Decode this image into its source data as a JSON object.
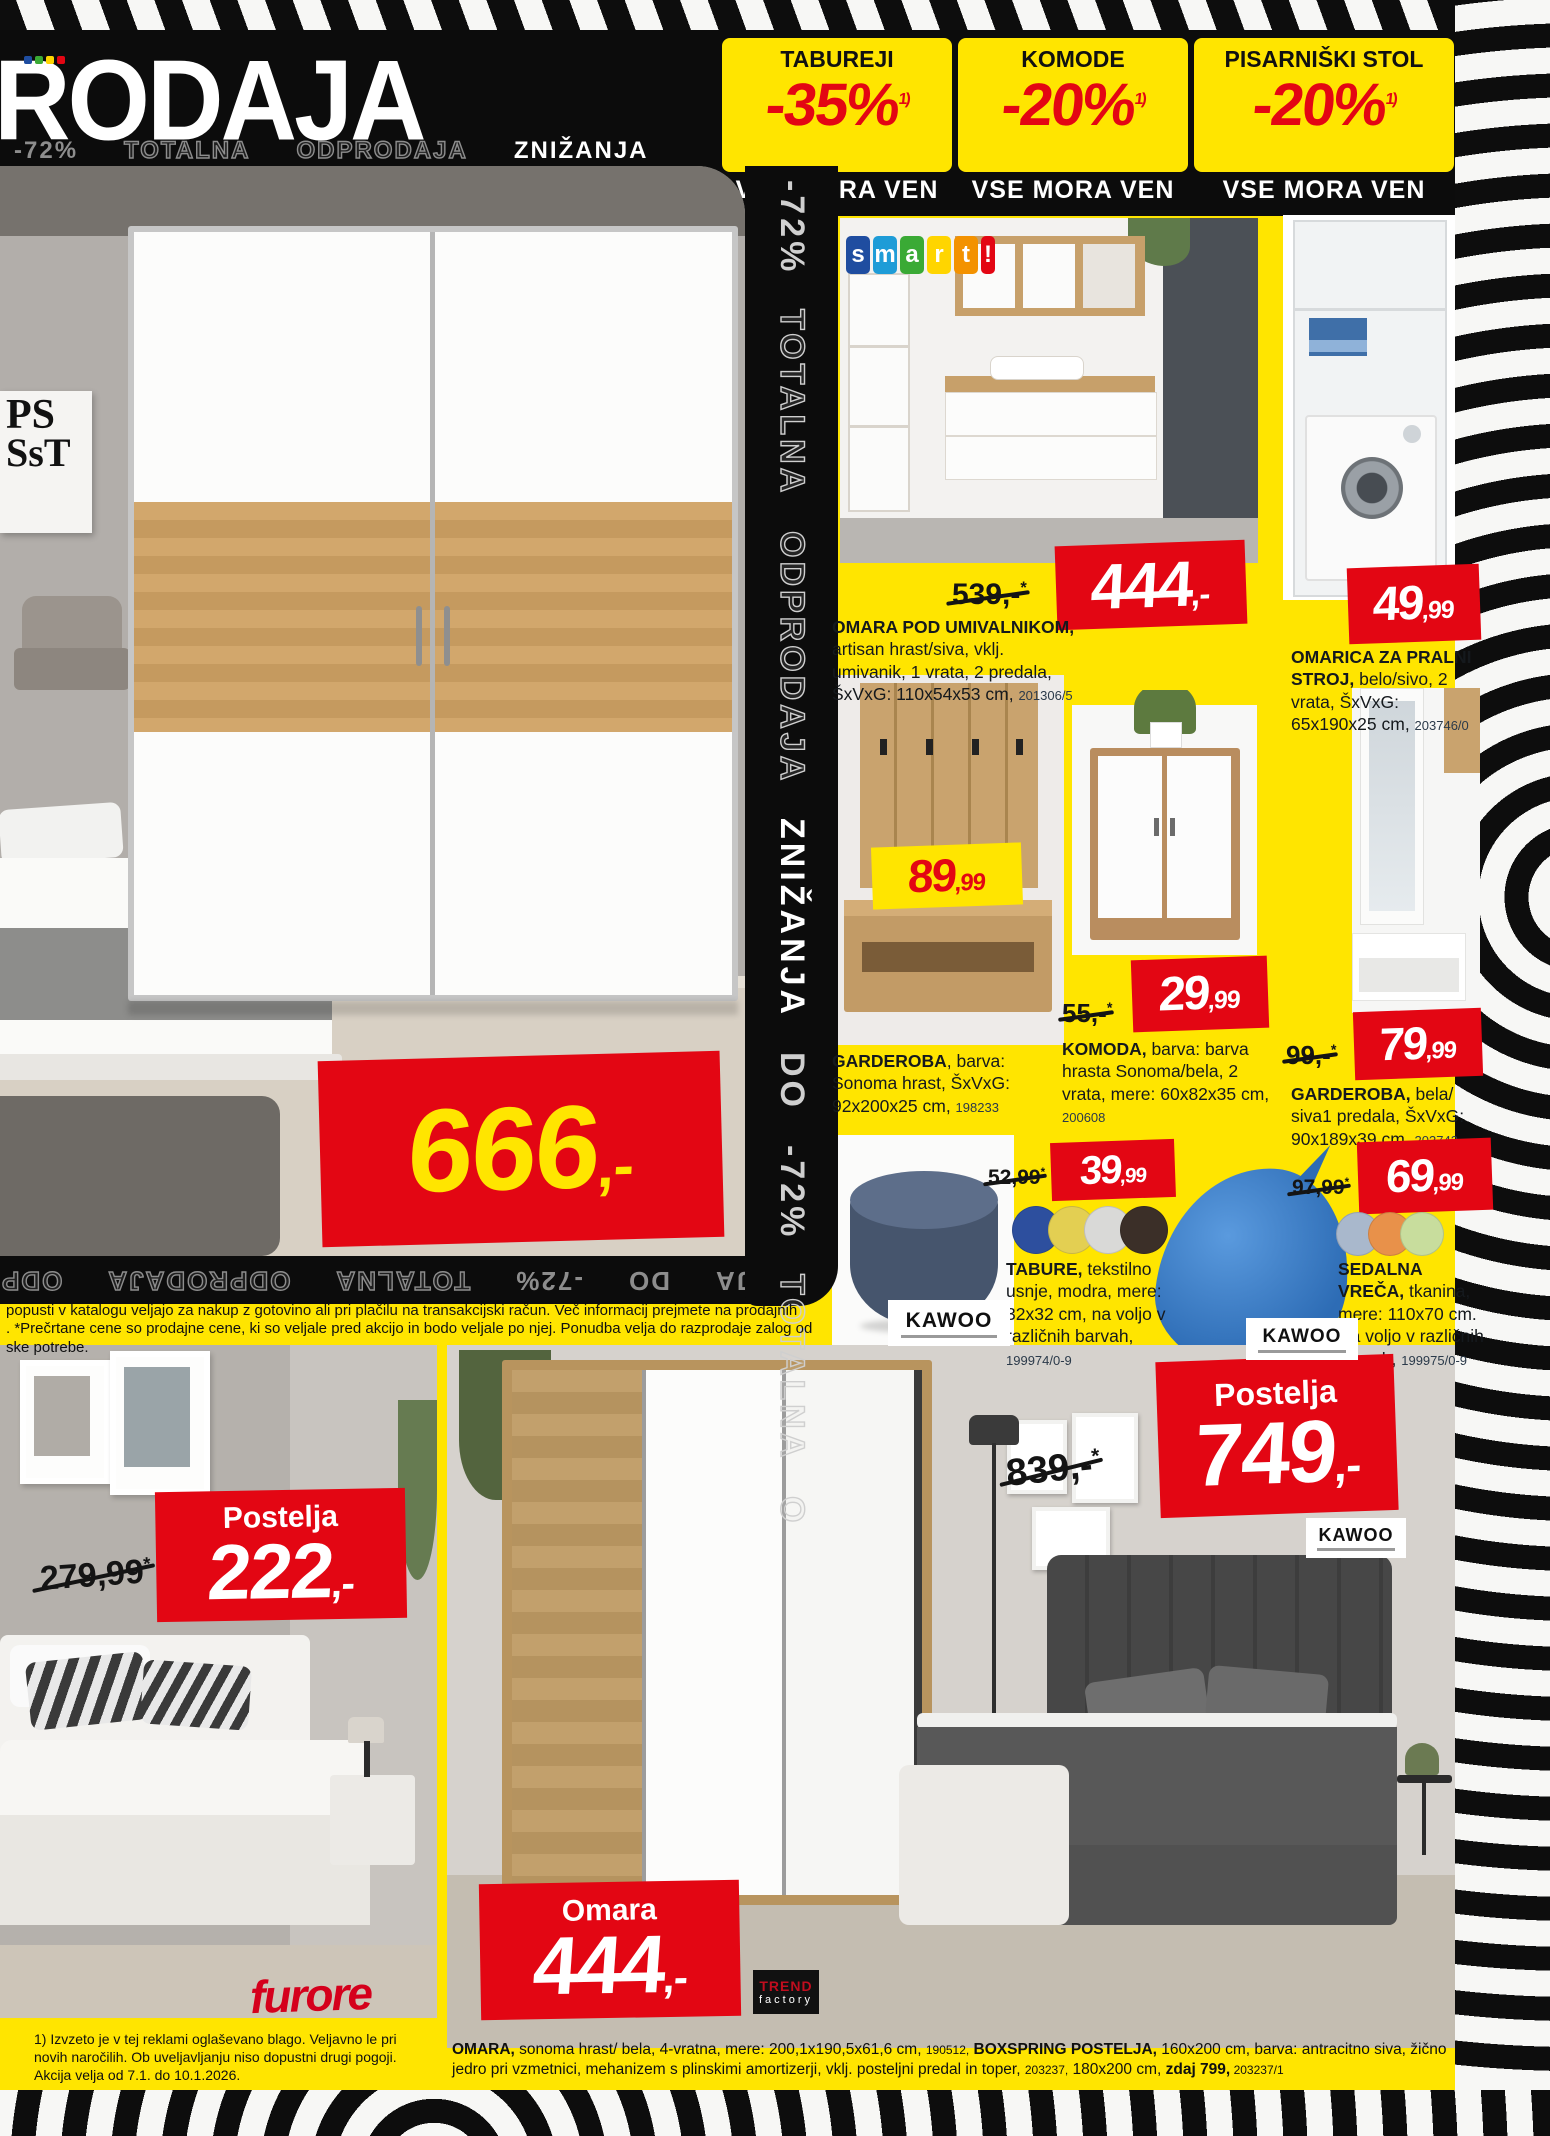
{
  "colors": {
    "yellow": "#ffe500",
    "red": "#e30613",
    "black": "#111111"
  },
  "top": {
    "headline": "RODAJA",
    "mini_logo_colors": [
      "#1f4da0",
      "#3aaa35",
      "#ffd500",
      "#e30613"
    ],
    "strip": [
      {
        "t": "-72%"
      },
      {
        "t": "TOTALNA"
      },
      {
        "t": "ODPRODAJA"
      },
      {
        "t": "ZNIŽANJA"
      }
    ],
    "promos": [
      {
        "category": "TABUREJI",
        "discount": "-35%",
        "note": "1)",
        "tagline": "VSE MORA VEN"
      },
      {
        "category": "KOMODE",
        "discount": "-20%",
        "note": "1)",
        "tagline": "VSE MORA VEN"
      },
      {
        "category": "PISARNIŠKI STOL",
        "discount": "-20%",
        "note": "1)",
        "tagline": "VSE MORA VEN"
      }
    ]
  },
  "watermark": {
    "vertical": [
      {
        "t": "-72%"
      },
      {
        "t": "TOTALNA"
      },
      {
        "t": "ODPRODAJA"
      },
      {
        "t": "ZNIŽANJA"
      },
      {
        "t": "DO"
      },
      {
        "t": "-72%"
      },
      {
        "t": "TOTALNA"
      },
      {
        "t": "O"
      }
    ],
    "flipped": [
      {
        "t": "ZNIŽANJA"
      },
      {
        "t": "DO"
      },
      {
        "t": "-72%"
      },
      {
        "t": "TOTALNA"
      },
      {
        "t": "ODPRODAJA"
      },
      {
        "t": "ODP"
      }
    ]
  },
  "logos": {
    "smart": [
      {
        "ch": "s",
        "bg": "#1f4da0"
      },
      {
        "ch": "m",
        "bg": "#1e9cd7"
      },
      {
        "ch": "a",
        "bg": "#3aaa35"
      },
      {
        "ch": "r",
        "bg": "#ffd500"
      },
      {
        "ch": "t",
        "bg": "#f39200"
      },
      {
        "ch": "!",
        "bg": "#e30613"
      }
    ],
    "kawoo": "KAWOO",
    "furore": "furore",
    "trend_top": "TREND",
    "trend_bottom": "factory"
  },
  "poster": {
    "line1": "PS",
    "line2": "SsT"
  },
  "hero": {
    "price_int": "666",
    "price_cents": ",-"
  },
  "products": [
    {
      "old": "539,-",
      "note": "*",
      "price_int": "444",
      "price_cents": ",-",
      "name": "OMARA POD UMIVALNIKOM,",
      "desc": " artisan hrast/siva, vklj. umivanik, 1 vrata, 2 predala, ŠxVxG: 110x54x53 cm, ",
      "sku": "201306/5"
    },
    {
      "price_int": "49",
      "price_cents": ",99",
      "name": "OMARICA ZA PRALNI STROJ,",
      "desc": " belo/sivo, 2 vrata, ŠxVxG: 65x190x25 cm, ",
      "sku": "203746/0"
    },
    {
      "price_int": "89",
      "price_cents": ",99",
      "name": "GARDEROBA",
      "desc": ", barva: Sonoma hrast, ŠxVxG: 92x200x25 cm, ",
      "sku": "198233"
    },
    {
      "old": "55,-",
      "note": "*",
      "price_int": "29",
      "price_cents": ",99",
      "name": "KOMODA,",
      "desc": " barva: barva hrasta Sonoma/bela, 2 vrata, mere: 60x82x35 cm, ",
      "sku": "200608"
    },
    {
      "old": "99,-",
      "note": "*",
      "price_int": "79",
      "price_cents": ",99",
      "name": "GARDEROBA,",
      "desc": " bela/ siva1 predala, ŠxVxG: 90x189x39 cm, ",
      "sku": "203742"
    },
    {
      "old": "52,99",
      "note": "*",
      "price_int": "39",
      "price_cents": ",99",
      "name": "TABURE,",
      "desc": " tekstilno usnje, modra, mere: 32x32 cm, na voljo v različnih barvah, ",
      "sku": "199974/0-9",
      "swatches": [
        "#2d4f9e",
        "#e3cf52",
        "#d9d9d7",
        "#3b2f28"
      ]
    },
    {
      "old": "97,99",
      "note": "*",
      "price_int": "69",
      "price_cents": ",99",
      "name": "SEDALNA VREČA,",
      "desc": " tkanina, mere: 110x70 cm. Na voljo v različnih barvah, ",
      "sku": "199975/0-9",
      "swatches": [
        "#a9b8cc",
        "#e8914a",
        "#c8dd9d"
      ]
    }
  ],
  "bottom": {
    "left_bed": {
      "old": "279,99",
      "note": "*",
      "label": "Postelja",
      "price_int": "222",
      "price_cents": ",-"
    },
    "right_bed": {
      "old": "839,-",
      "note": "*",
      "label": "Postelja",
      "price_int": "749",
      "price_cents": ",-"
    },
    "omara": {
      "label": "Omara",
      "price_int": "444",
      "price_cents": ",-"
    }
  },
  "fineprint": {
    "mid1": "popusti v katalogu veljajo za nakup z gotovino ali pri plačilu na transakcijski račun. Več informacij prejmete na prodajnih",
    "mid2": ". *Prečrtane cene so prodajne cene, ki so veljale pred akcijo in bodo veljale po njej. Ponudba velja do razprodaje zalog od",
    "mid3": "ske potrebe.",
    "bottom_left_1": "1) Izvzeto je v tej reklami oglaševano blago. Veljavno le pri",
    "bottom_left_2": "novih naročilih. Ob uveljavljanju niso dopustni drugi pogoji.",
    "bottom_left_3": "Akcija velja od 7.1. do 10.1.2026.",
    "bottom_right": {
      "n1": "OMARA,",
      "d1": " sonoma hrast/ bela, 4-vratna, mere: 200,1x190,5x61,6 cm, ",
      "s1": "190512,",
      "n2": " BOXSPRING POSTELJA,",
      "d2": " 160x200 cm, barva: antracitno siva, žično jedro pri vzmetnici, mehanizem s plinskimi amortizerji, vklj. posteljni predal in toper, ",
      "s2": "203237,",
      "d3": " 180x200 cm, ",
      "n3": "zdaj 799,",
      "s3": " 203237/1"
    }
  }
}
